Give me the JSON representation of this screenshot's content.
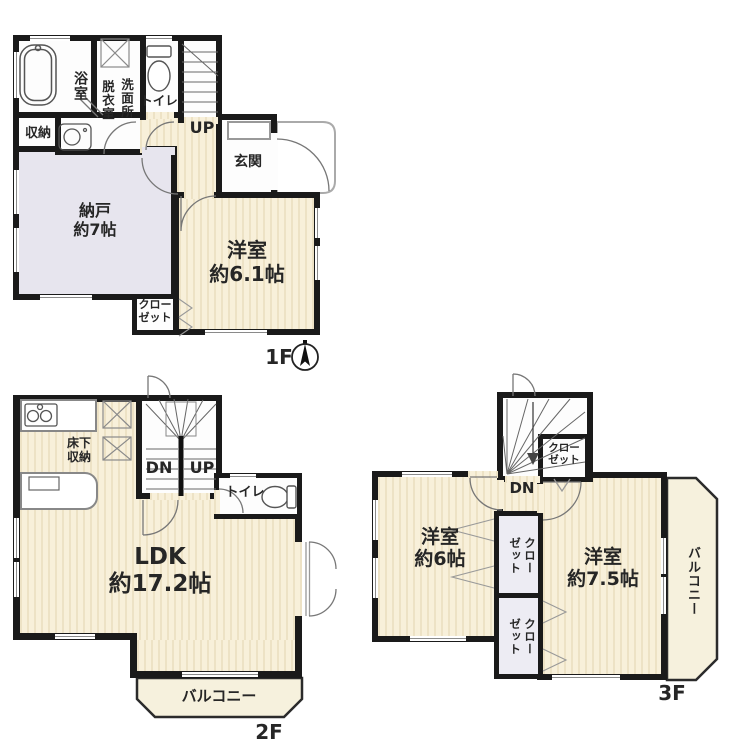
{
  "f1": {
    "floor_label": "1F",
    "bath": "浴室",
    "dressing": "脱衣室",
    "washroom": "洗面所",
    "toilet": "トイレ",
    "up": "UP",
    "entrance": "玄関",
    "storage": "収納",
    "nando": "納戸",
    "nando_size": "約7帖",
    "closet_l1": "クロー",
    "closet_l2": "ゼット",
    "western": "洋室",
    "western_size": "約6.1帖"
  },
  "f2": {
    "floor_label": "2F",
    "underfloor_l1": "床下",
    "underfloor_l2": "収納",
    "dn": "DN",
    "up": "UP",
    "toilet": "トイレ",
    "ldk": "LDK",
    "ldk_size": "約17.2帖",
    "balcony": "バルコニー"
  },
  "f3": {
    "floor_label": "3F",
    "closet_top_l1": "クロー",
    "closet_top_l2": "ゼット",
    "dn": "DN",
    "western6": "洋室",
    "western6_size": "約6帖",
    "closet_a_l1": "クロー",
    "closet_a_l2": "ゼット",
    "closet_b_l1": "クロー",
    "closet_b_l2": "ゼット",
    "western75": "洋室",
    "western75_size": "約7.5帖",
    "balcony": "バルコニー"
  },
  "colors": {
    "wall": "#1a1a1a",
    "room_cream": "#f8f0da",
    "room_lavender": "#e7e5ee",
    "balcony_fill": "#f6f1dd"
  }
}
